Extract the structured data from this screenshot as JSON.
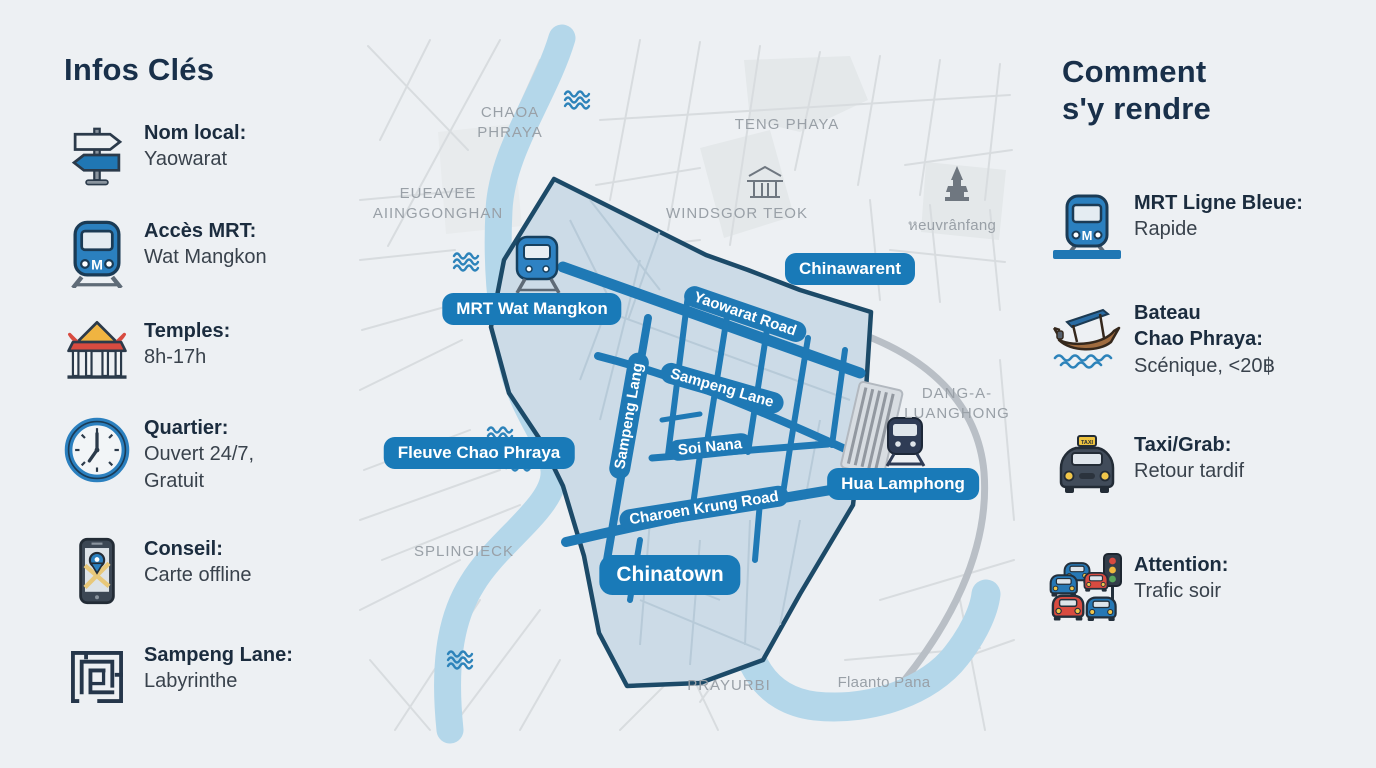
{
  "left_panel": {
    "title": "Infos Clés",
    "items": [
      {
        "icon": "signpost-icon",
        "label": "Nom local:",
        "value": "Yaowarat"
      },
      {
        "icon": "mrt-train-icon",
        "label": "Accès MRT:",
        "value": "Wat Mangkon"
      },
      {
        "icon": "temple-icon",
        "label": "Temples:",
        "value": "8h-17h"
      },
      {
        "icon": "clock-icon",
        "label": "Quartier:",
        "value": "Ouvert 24/7,\nGratuit"
      },
      {
        "icon": "phone-map-icon",
        "label": "Conseil:",
        "value": "Carte offline"
      },
      {
        "icon": "maze-icon",
        "label": "Sampeng Lane:",
        "value": "Labyrinthe"
      }
    ]
  },
  "right_panel": {
    "title": "Comment\ns'y rendre",
    "items": [
      {
        "icon": "mrt-line-icon",
        "label": "MRT Ligne Bleue:",
        "value": "Rapide"
      },
      {
        "icon": "boat-icon",
        "label": "Bateau\nChao Phraya:",
        "value": "Scénique, <20฿"
      },
      {
        "icon": "taxi-icon",
        "label": "Taxi/Grab:",
        "value": "Retour tardif"
      },
      {
        "icon": "traffic-jam-icon",
        "label": "Attention:",
        "value": "Trafic soir"
      }
    ]
  },
  "map": {
    "badges": [
      {
        "text": "MRT Wat Mangkon"
      },
      {
        "text": "Chinawarent"
      },
      {
        "text": "Fleuve Chao Phraya"
      },
      {
        "text": "Hua Lamphong"
      },
      {
        "text": "Chinatown"
      }
    ],
    "road_labels": [
      {
        "text": "Yaowarat Road"
      },
      {
        "text": "Sampeng Lane"
      },
      {
        "text": "Sampeng Lang"
      },
      {
        "text": "Soi Nana"
      },
      {
        "text": "Charoen Krung Road"
      }
    ],
    "area_labels": [
      {
        "text": "CHAOA\nPHRAYA"
      },
      {
        "text": "TENG PHAYA"
      },
      {
        "text": "EUEAVEE\nAIINGGONGHAN"
      },
      {
        "text": "WINDSGOR TEOK"
      },
      {
        "text": "หeuvrânfang"
      },
      {
        "text": "DANG-A-\nLUANGHONG"
      },
      {
        "text": "SPLINGIECK"
      },
      {
        "text": "PRAYURBI"
      },
      {
        "text": "Flaanto Pana"
      }
    ],
    "colors": {
      "badge_blue": "#197ab8",
      "road_blue": "#1f79b5",
      "polygon_fill": "#ccdbe7",
      "polygon_stroke": "#1c4a68",
      "river": "#b4d7ea",
      "label_gray": "#99a0a7",
      "heading_navy": "#19304a"
    }
  }
}
